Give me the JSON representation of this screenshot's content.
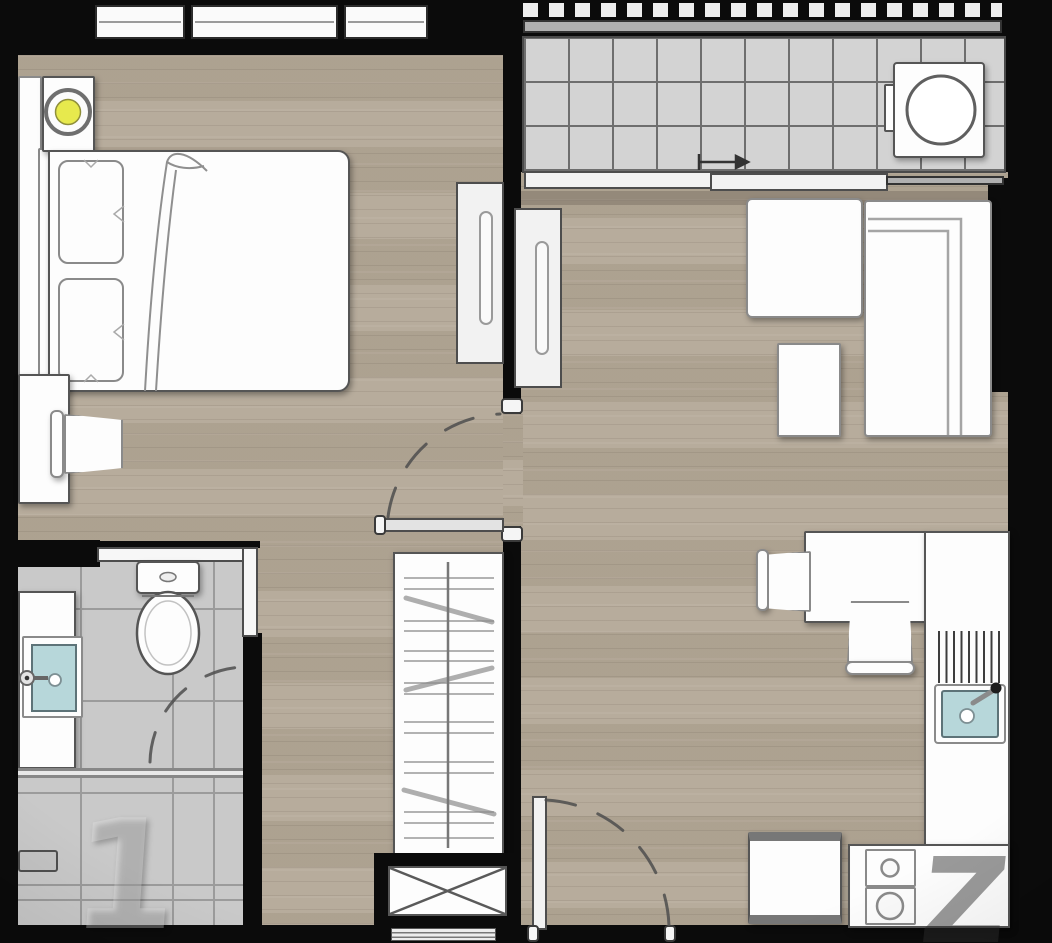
{
  "meta": {
    "kind": "floor-plan",
    "text_labels_visible": false
  },
  "watermark": {
    "left_glyph": "1",
    "right_glyph": "Z"
  },
  "colors": {
    "wall": "#0b0b0b",
    "wood": "#b3a897",
    "balcony-tile": "#d3d3d3",
    "bath-tile": "#c9c9c9",
    "grid": "#6e6e6e",
    "outline": "#555555",
    "sink-blue": "#b7d7da",
    "lamp-yellow": "#e7e94d"
  },
  "rooms": [
    {
      "name": "bedroom",
      "floor": "wood",
      "items": [
        "double-bed",
        "pillow",
        "pillow",
        "headboard-shelf",
        "nightstand",
        "table-lamp",
        "desk",
        "desk-chair",
        "sliding-door",
        "window"
      ]
    },
    {
      "name": "balcony",
      "floor": "tile",
      "items": [
        "railing",
        "washing-machine",
        "sliding-glass-door",
        "slide-direction-arrow"
      ]
    },
    {
      "name": "living-dining",
      "floor": "wood",
      "items": [
        "sofa",
        "armchair",
        "side-table",
        "dining-table",
        "dining-chair",
        "dining-chair"
      ]
    },
    {
      "name": "kitchen",
      "floor": "wood",
      "items": [
        "l-shaped-counter",
        "kitchen-sink",
        "faucet",
        "dish-rack",
        "two-burner-stove",
        "refrigerator"
      ]
    },
    {
      "name": "bathroom",
      "floor": "tile",
      "items": [
        "toilet",
        "vanity-counter",
        "wash-basin",
        "faucet",
        "shower-head",
        "shower-partition",
        "pocket-door",
        "door-swing-arc"
      ]
    },
    {
      "name": "corridor-entry",
      "floor": "wood",
      "items": [
        "wardrobe",
        "clothes-rail",
        "service-shaft",
        "entrance-door",
        "door-swing-arc"
      ]
    }
  ]
}
